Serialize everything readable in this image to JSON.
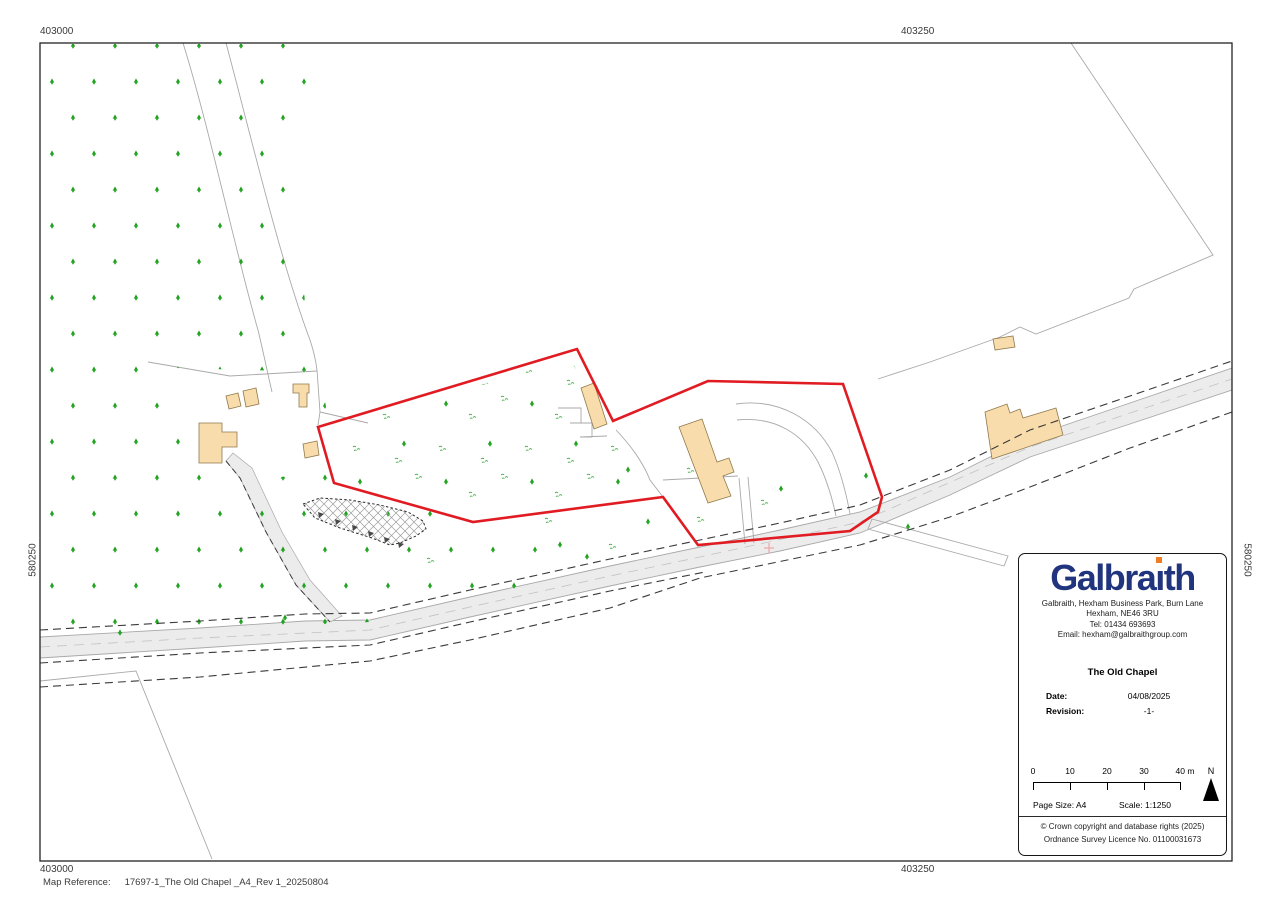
{
  "map": {
    "grid_labels": {
      "top_left": "403000",
      "top_right": "403250",
      "bottom_left": "403000",
      "bottom_right": "403250",
      "left_side": "580250",
      "right_side": "580250"
    },
    "map_reference_label": "Map Reference:",
    "map_reference_value": "17697-1_The Old Chapel _A4_Rev 1_20250804",
    "colors": {
      "boundary_red": "#e11b22",
      "building_fill": "#f9dcab",
      "building_stroke": "#8f7a4e",
      "tree_green": "#1ea21e",
      "road_fill": "#ececec",
      "field_line_gray": "#a9a9a9",
      "dashed_line": "#3a3a3a",
      "logo_blue": "#21357e",
      "logo_dot_orange": "#ef7d23"
    }
  },
  "info_panel": {
    "logo": {
      "text_before_i": "Galbra",
      "dotless_i": "ı",
      "text_after_i": "th"
    },
    "address_lines": [
      "Galbraith, Hexham Business Park, Burn Lane",
      "Hexham, NE46 3RU",
      "Tel: 01434 693693",
      "Email: hexham@galbraithgroup.com"
    ],
    "title": "The Old Chapel",
    "date_label": "Date:",
    "date_value": "04/08/2025",
    "revision_label": "Revision:",
    "revision_value": "-1-",
    "scalebar": {
      "ticks": [
        "0",
        "10",
        "20",
        "30",
        "40 m"
      ],
      "north_label": "N"
    },
    "page_size": "Page Size: A4",
    "scale": "Scale: 1:1250",
    "copyright_lines": [
      "© Crown copyright and database rights (2025)",
      "Ordnance Survey Licence No. 01100031673"
    ]
  }
}
